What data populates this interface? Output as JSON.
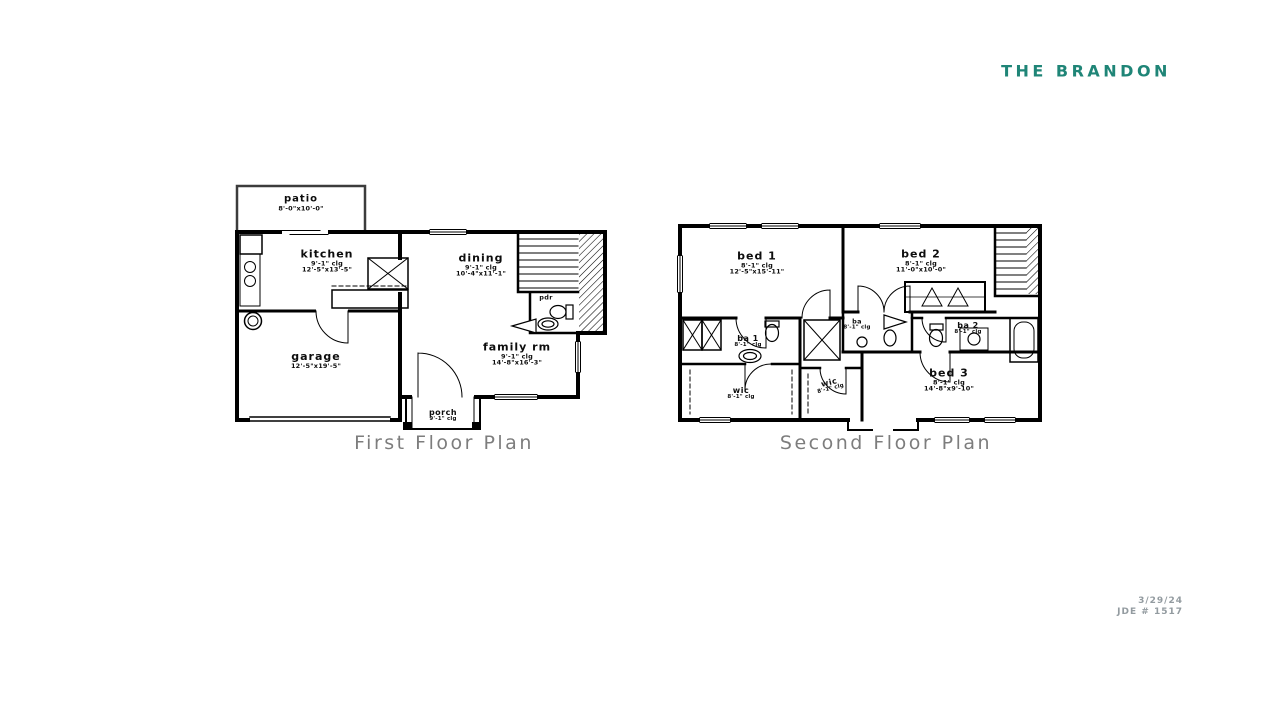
{
  "title": "THE BRANDON",
  "first_floor": {
    "caption": "First Floor Plan",
    "rooms": {
      "patio": {
        "name": "patio",
        "dims": "8'-0\"x10'-0\""
      },
      "kitchen": {
        "name": "kitchen",
        "clg": "9'-1\" clg",
        "dims": "12'-5\"x13'-5\""
      },
      "dining": {
        "name": "dining",
        "clg": "9'-1\" clg",
        "dims": "10'-4\"x11'-1\""
      },
      "garage": {
        "name": "garage",
        "dims": "12'-5\"x19'-5\""
      },
      "family": {
        "name": "family rm",
        "clg": "9'-1\" clg",
        "dims": "14'-8\"x16'-3\""
      },
      "porch": {
        "name": "porch",
        "clg": "9'-1\" clg"
      },
      "pdr": {
        "name": "pdr"
      }
    }
  },
  "second_floor": {
    "caption": "Second Floor Plan",
    "rooms": {
      "bed1": {
        "name": "bed 1",
        "clg": "8'-1\" clg",
        "dims": "12'-5\"x15'-11\""
      },
      "bed2": {
        "name": "bed 2",
        "clg": "8'-1\" clg",
        "dims": "11'-0\"x10'-0\""
      },
      "ba1": {
        "name": "ba 1",
        "clg": "8'-1\" clg"
      },
      "ba": {
        "name": "ba",
        "clg": "8'-1\" clg"
      },
      "ba2": {
        "name": "ba 2",
        "clg": "8'-1\" clg"
      },
      "wic1": {
        "name": "wic",
        "clg": "8'-1\" clg"
      },
      "wic2": {
        "name": "wic",
        "clg": "8'-1\" clg"
      },
      "bed3": {
        "name": "bed 3",
        "clg": "8'-1\" clg",
        "dims": "14'-8\"x9'-10\""
      }
    }
  },
  "footer": {
    "date": "3/29/24",
    "job_number": "JDE # 1517"
  },
  "colors": {
    "title": "#1f8577",
    "caption": "#7d7d7d",
    "line": "#000000"
  }
}
